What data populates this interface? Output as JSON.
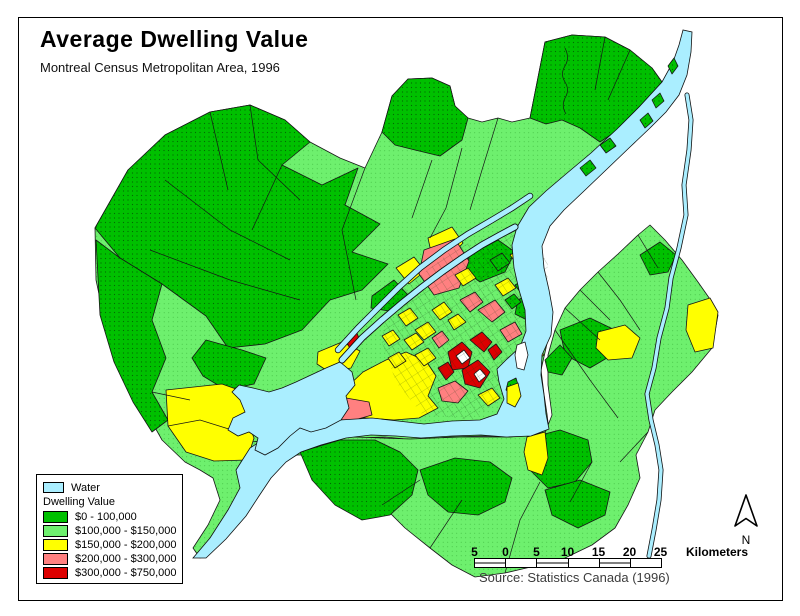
{
  "title": "Average Dwelling Value",
  "subtitle": "Montreal Census Metropolitan Area, 1996",
  "legend": {
    "water_label": "Water",
    "group_label": "Dwelling Value",
    "water_color": "#aaeeff",
    "classes": [
      {
        "label": "$0 - 100,000",
        "color": "#00c000"
      },
      {
        "label": "$100,000 - $150,000",
        "color": "#6ef06e"
      },
      {
        "label": "$150,000 - $200,000",
        "color": "#ffff00"
      },
      {
        "label": "$200,000 - $300,000",
        "color": "#ff8080"
      },
      {
        "label": "$300,000 - $750,000",
        "color": "#dd0000"
      }
    ]
  },
  "scale_bar": {
    "ticks": [
      "5",
      "0",
      "5",
      "10",
      "15",
      "20",
      "25"
    ],
    "unit_label": "Kilometers"
  },
  "north_arrow": {
    "label": "N"
  },
  "source": "Source: Statistics Canada (1996)"
}
